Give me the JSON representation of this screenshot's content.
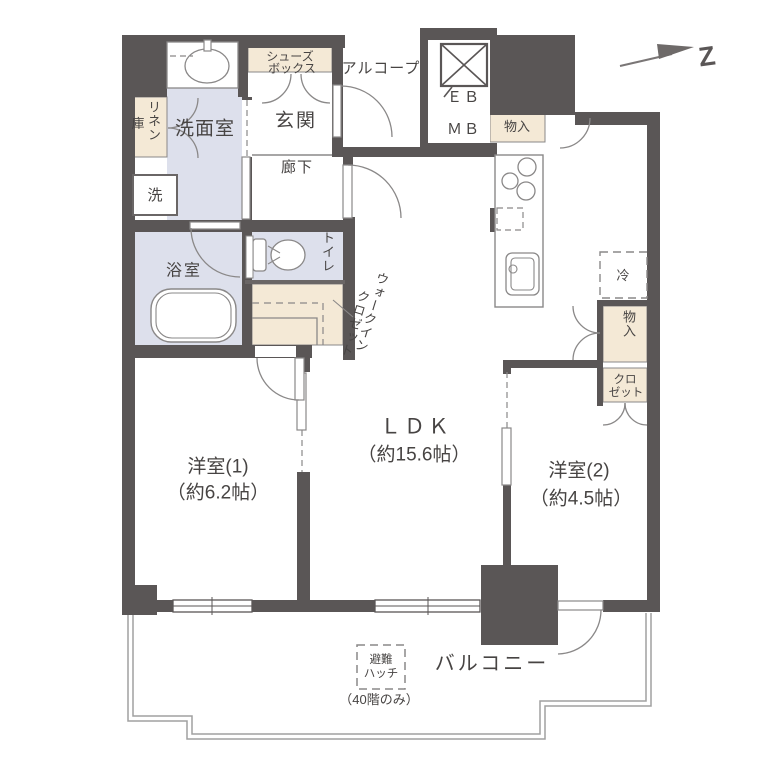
{
  "colors": {
    "wall": "#5a5656",
    "wet_area": "#dde0ec",
    "storage_area": "#f4e9d6",
    "thin_line": "#8a8888",
    "text": "#474443"
  },
  "rooms": {
    "ldk": {
      "name": "ＬＤＫ",
      "size": "（約15.6帖）"
    },
    "western1": {
      "name": "洋室(1)",
      "size": "（約6.2帖）"
    },
    "western2": {
      "name": "洋室(2)",
      "size": "（約4.5帖）"
    },
    "balcony": {
      "name": "バルコニー"
    },
    "entrance": {
      "name": "玄関"
    },
    "corridor": {
      "name": "廊下"
    },
    "washroom": {
      "name": "洗面室"
    },
    "bathroom": {
      "name": "浴室"
    },
    "toilet": {
      "name": "トイレ"
    },
    "alcove": {
      "name": "アルコープ"
    }
  },
  "storage": {
    "shoes_box": {
      "line1": "シューズ",
      "line2": "ボックス"
    },
    "linen": {
      "main": "リネン",
      "sub": "庫"
    },
    "walk_in_closet": {
      "line1": "ウォークイン",
      "line2": "クロゼット"
    },
    "storage_top": {
      "name": "物入"
    },
    "storage_right": {
      "name": "物入"
    },
    "closet": {
      "line1": "クロ",
      "line2": "ゼット"
    }
  },
  "fixtures": {
    "washer": "洗",
    "refrigerator": "冷",
    "elevator_box": "ＥＢ",
    "meter_box": "ＭＢ"
  },
  "balcony_notes": {
    "hatch_line1": "避難",
    "hatch_line2": "ハッチ",
    "hatch_note": "（40階のみ）"
  },
  "compass": {
    "label": "Z"
  }
}
